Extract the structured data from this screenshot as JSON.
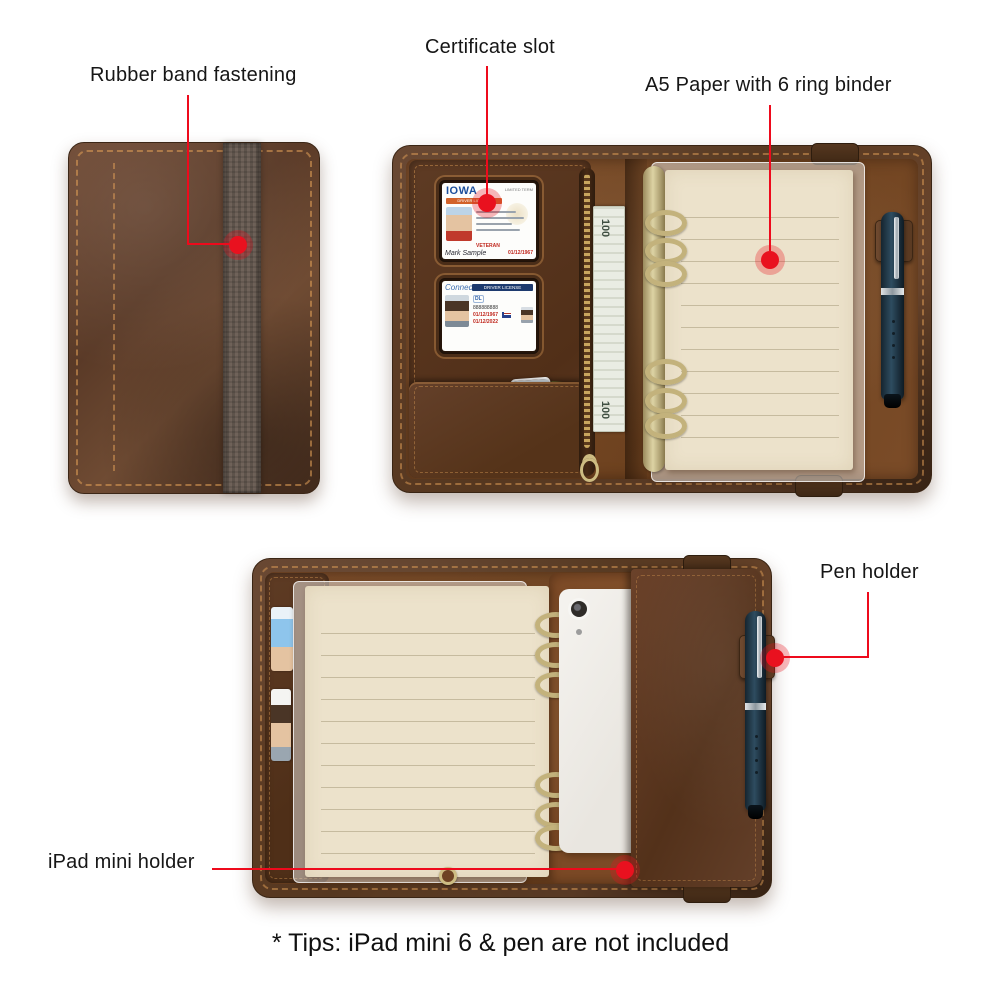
{
  "annotations": {
    "accent_color": "#e9111f",
    "rubber_band_label": "Rubber band fastening",
    "certificate_label": "Certificate slot",
    "a5_label": "A5 Paper with 6 ring binder",
    "pen_label": "Pen holder",
    "ipad_label": "iPad mini holder",
    "tips": "* Tips: iPad mini 6 & pen are not included"
  },
  "cards": {
    "iowa": {
      "state": "IOWA",
      "type": "DRIVER LICENSE",
      "term": "LIMITED TERM",
      "veteran": "VETERAN",
      "signature": "Mark Sample",
      "date": "01/12/1967"
    },
    "connecticut": {
      "state": "Connecticut",
      "type": "DRIVER LICENSE",
      "class": "DL",
      "number": "888888888",
      "date1": "01/12/1967",
      "date2": "01/12/2022"
    }
  },
  "bill": {
    "denomination": "100"
  },
  "colors": {
    "leather_dark": "#4c3120",
    "leather_mid": "#6e4527",
    "suede": "#8a5a36",
    "paper_cream": "#ece2cb",
    "brass": "#c3b27c",
    "pen_body": "#203647",
    "elastic_band": "#6a5c52",
    "ipad_white": "#f2f0ec",
    "callout_red": "#ee0a1c"
  }
}
